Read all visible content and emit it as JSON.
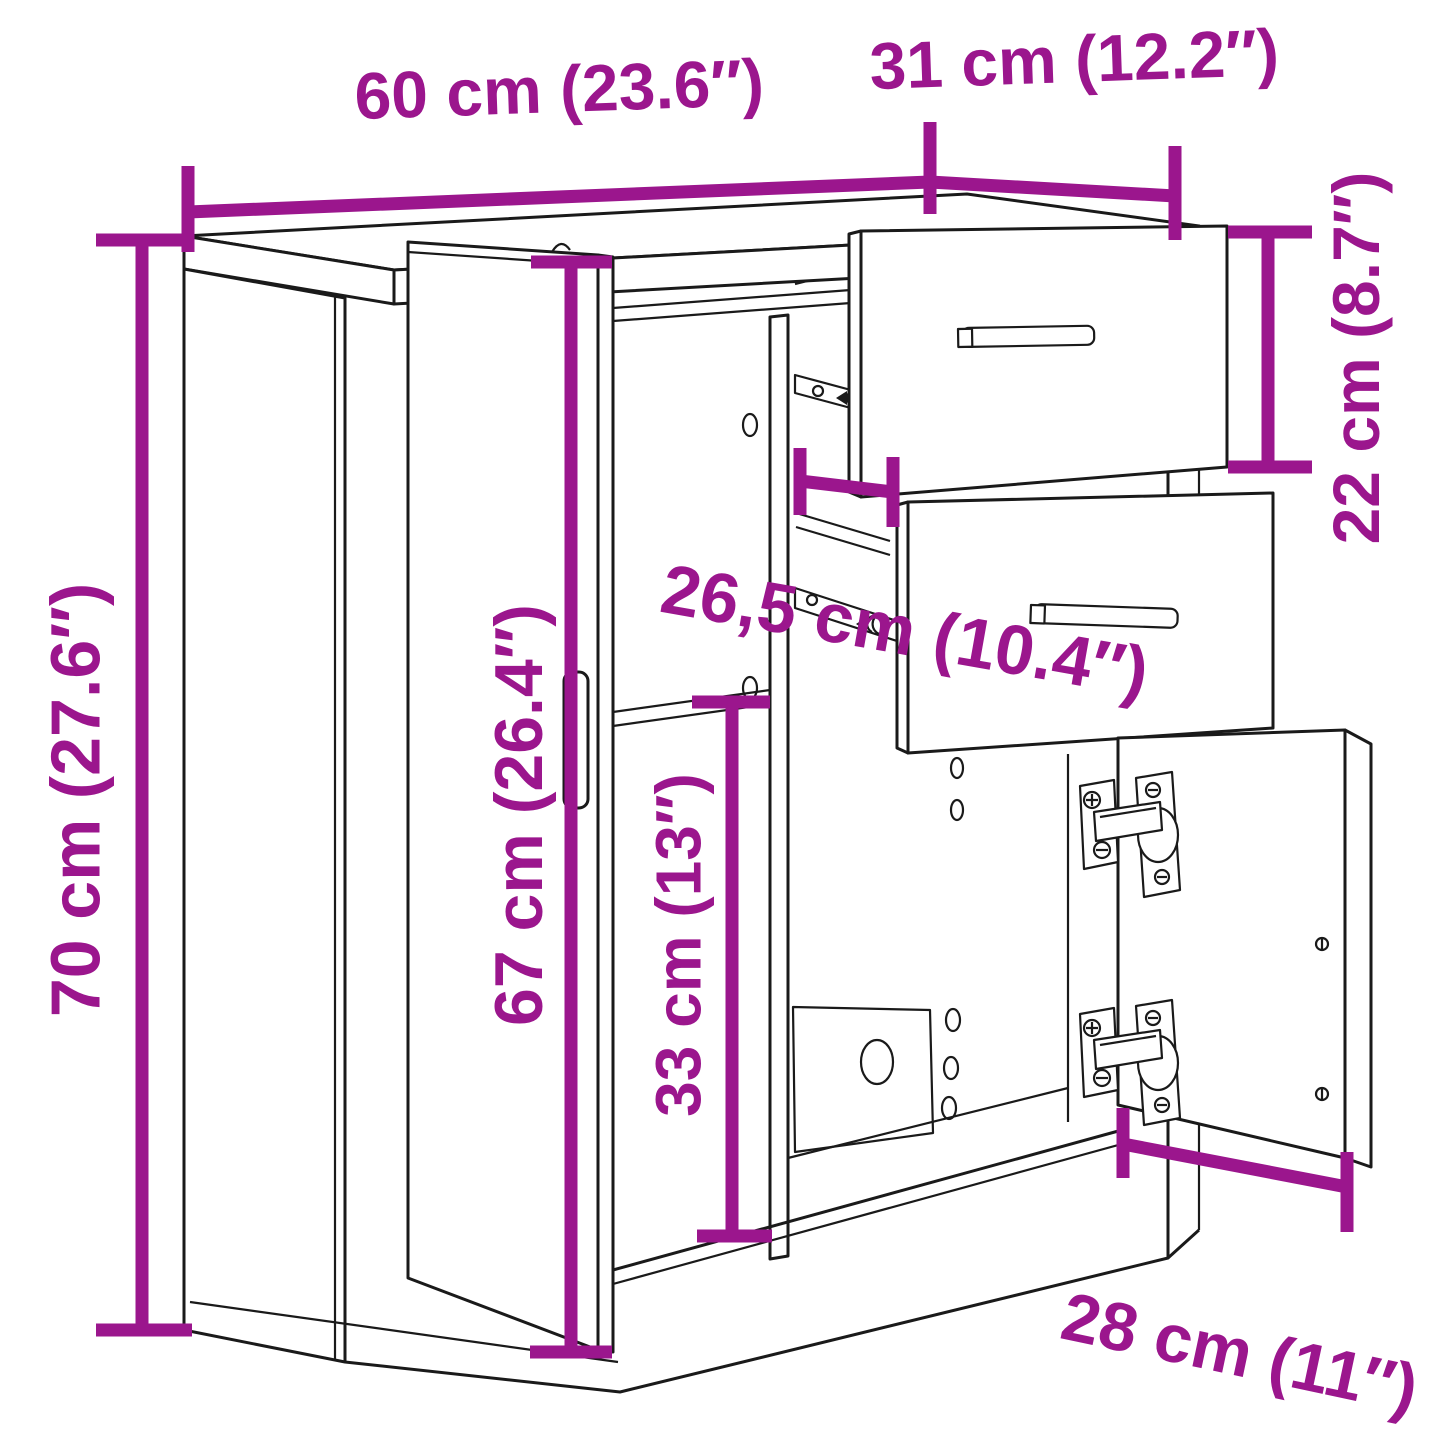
{
  "diagram": {
    "accent_color": "#9B168D",
    "line_color": "#1A1A1A",
    "background_color": "#FFFFFF",
    "dimensions": {
      "width": {
        "label": "60 cm (23.6″)",
        "cm": "60",
        "inches": "23.6"
      },
      "depth": {
        "label": "31 cm (12.2″)",
        "cm": "31",
        "inches": "12.2"
      },
      "height": {
        "label": "70 cm (27.6″)",
        "cm": "70",
        "inches": "27.6"
      },
      "door_height": {
        "label": "67 cm (26.4″)",
        "cm": "67",
        "inches": "26.4"
      },
      "inner_width": {
        "label": "26,5 cm (10.4″)",
        "cm": "26,5",
        "inches": "10.4"
      },
      "drawer_height": {
        "label": "22 cm (8.7″)",
        "cm": "22",
        "inches": "8.7"
      },
      "compartment_height": {
        "label": "33 cm (13″)",
        "cm": "33",
        "inches": "13"
      },
      "door_width": {
        "label": "28 cm (11″)",
        "cm": "28",
        "inches": "11"
      }
    }
  }
}
